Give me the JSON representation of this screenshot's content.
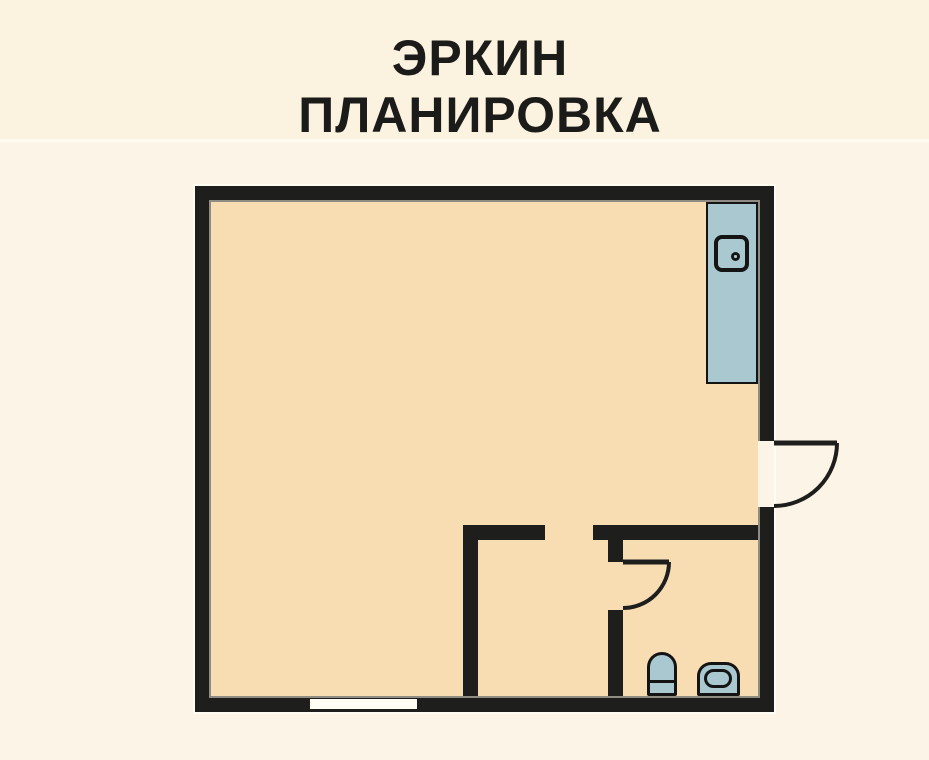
{
  "header": {
    "title_line1": "ЭРКИН",
    "title_line2": "ПЛАНИРОВКА"
  },
  "plan": {
    "fixtures": {
      "counter": "kitchen-counter",
      "appliance": "counter-sink-unit",
      "toilet": "toilet",
      "sink": "pedestal-sink",
      "window": "window",
      "entrance_door": "entrance-door-swing",
      "bathroom_door": "bathroom-door-swing"
    }
  },
  "colors": {
    "page_bg": "#fcf5e7",
    "header_bg": "#fbf2e0",
    "divider": "#fffdf2",
    "title_color": "#1b1b19",
    "wall": "#1e1f1d",
    "floor": "#f8dcb2",
    "fixture_fill": "#a9c8d0",
    "fixture_stroke": "#141414",
    "window_fill": "#fffdf4"
  }
}
